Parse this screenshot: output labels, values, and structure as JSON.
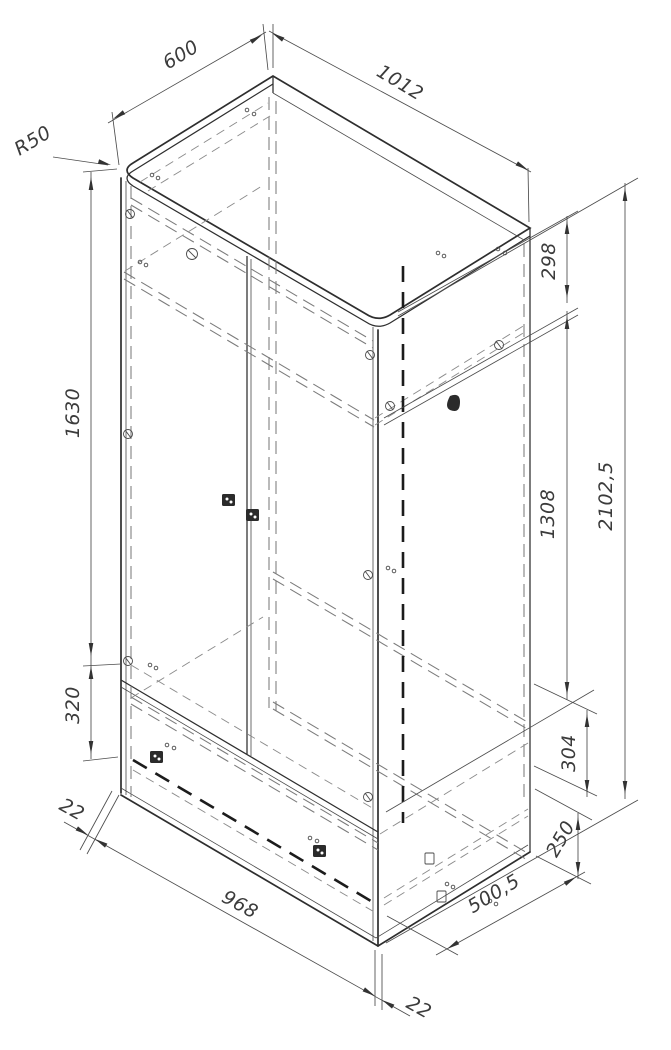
{
  "drawing": {
    "kind": "isometric-furniture-assembly-drawing",
    "subject": "two-door wardrobe carcass with lower drawer section",
    "background_color": "#ffffff",
    "line_color": "#2e2e2e",
    "hidden_line_color": "#7b7b7b",
    "dimension_color": "#3b3b3b",
    "dimensions": {
      "top_depth": "600",
      "top_width": "1012",
      "corner_radius": "R50",
      "top_shelf_offset": "298",
      "door_section_height": "1308",
      "overall_height": "2102,5",
      "left_side_height": "1630",
      "lower_section_height": "320",
      "panel_thickness_left": "22",
      "interior_width": "968",
      "panel_thickness_bottom": "22",
      "bottom_depth": "500,5",
      "plinth_height": "250",
      "drawer_box_height": "304"
    }
  }
}
